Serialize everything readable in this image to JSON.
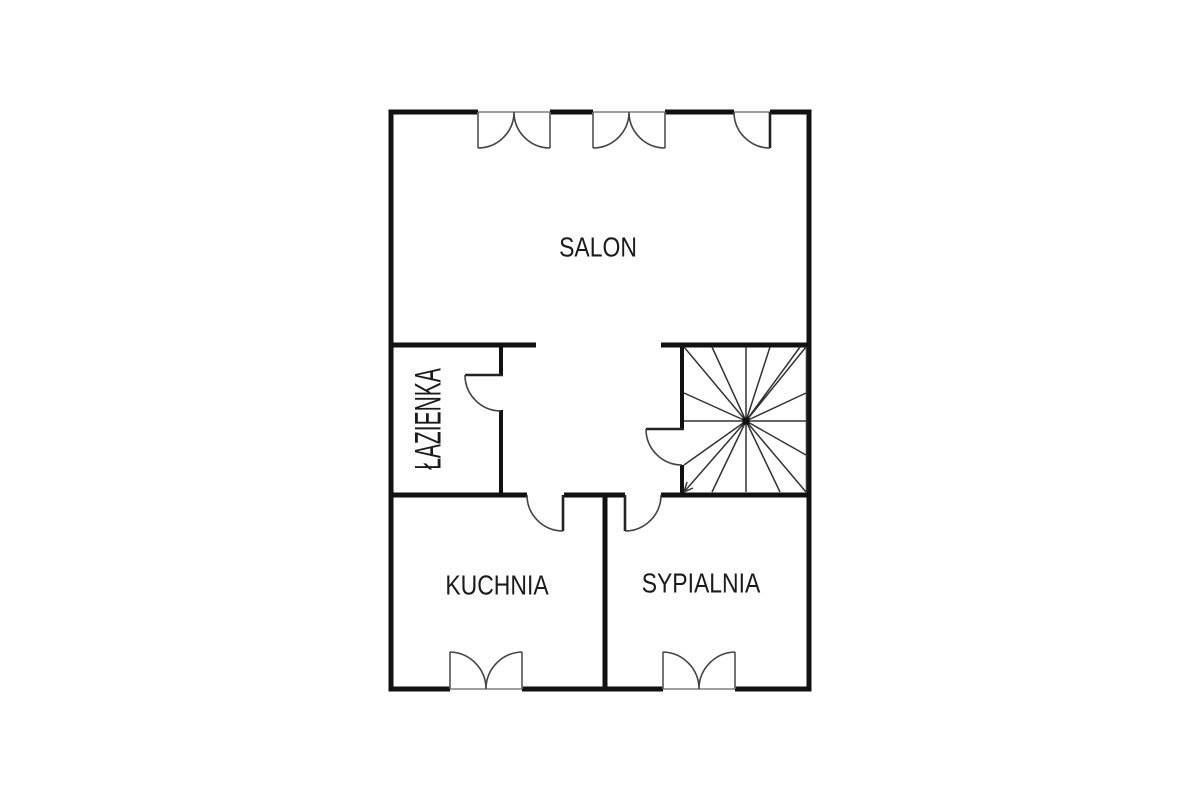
{
  "floorplan": {
    "kind": "apartment-floor-plan",
    "rooms": {
      "salon": {
        "label": "SALON"
      },
      "lazienka": {
        "label": "ŁAZIENKA"
      },
      "kuchnia": {
        "label": "KUCHNIA"
      },
      "sypialnia": {
        "label": "SYPIALNIA"
      }
    },
    "elements": {
      "staircase": "spiral-winder-staircase",
      "doors": [
        "entry-door-top-right",
        "bathroom-door",
        "staircase-door",
        "kitchen-door",
        "bedroom-door"
      ],
      "windows": [
        "salon-window-left",
        "salon-window-center",
        "kitchen-window",
        "bedroom-window"
      ]
    },
    "colors": {
      "wall": "#111111",
      "thin_line": "#444444",
      "jamb": "#666666",
      "text": "#1b1b1b",
      "background": "#ffffff"
    }
  }
}
